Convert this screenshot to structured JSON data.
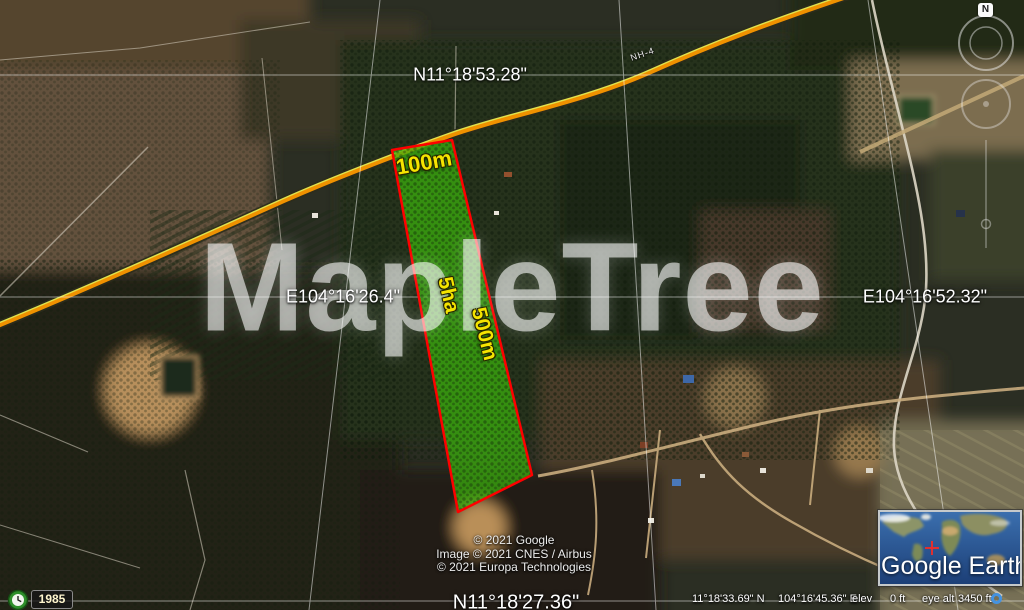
{
  "app": {
    "watermark": "MapleTree"
  },
  "map_overlay": {
    "road_label": "NH-4",
    "graticule_labels": {
      "lat_top": "N11°18'53.28\"",
      "lat_bottom": "N11°18'27.36\"",
      "lon_left": "E104°16'26.4\"",
      "lon_right": "E104°16'52.32\""
    },
    "parcel": {
      "width_label": "100m",
      "length_label": "500m",
      "area_label": "5ha",
      "fill_color": "#3cb30c",
      "border_color": "#ff0000",
      "label_color": "#f5e400"
    },
    "copyright_lines": [
      "© 2021 Google",
      "Image © 2021 CNES / Airbus",
      "© 2021 Europa Technologies"
    ]
  },
  "status_bar": {
    "latitude": "11°18'33.69\" N",
    "longitude": "104°16'45.36\" E",
    "elev_label": "elev",
    "elev_value": "0 ft",
    "eye_alt_label": "eye alt",
    "eye_alt_value": "3450 ft"
  },
  "time_control": {
    "year": "1985"
  },
  "overview_inset": {
    "logo": "Google Earth"
  },
  "compass": {
    "north": "N"
  }
}
